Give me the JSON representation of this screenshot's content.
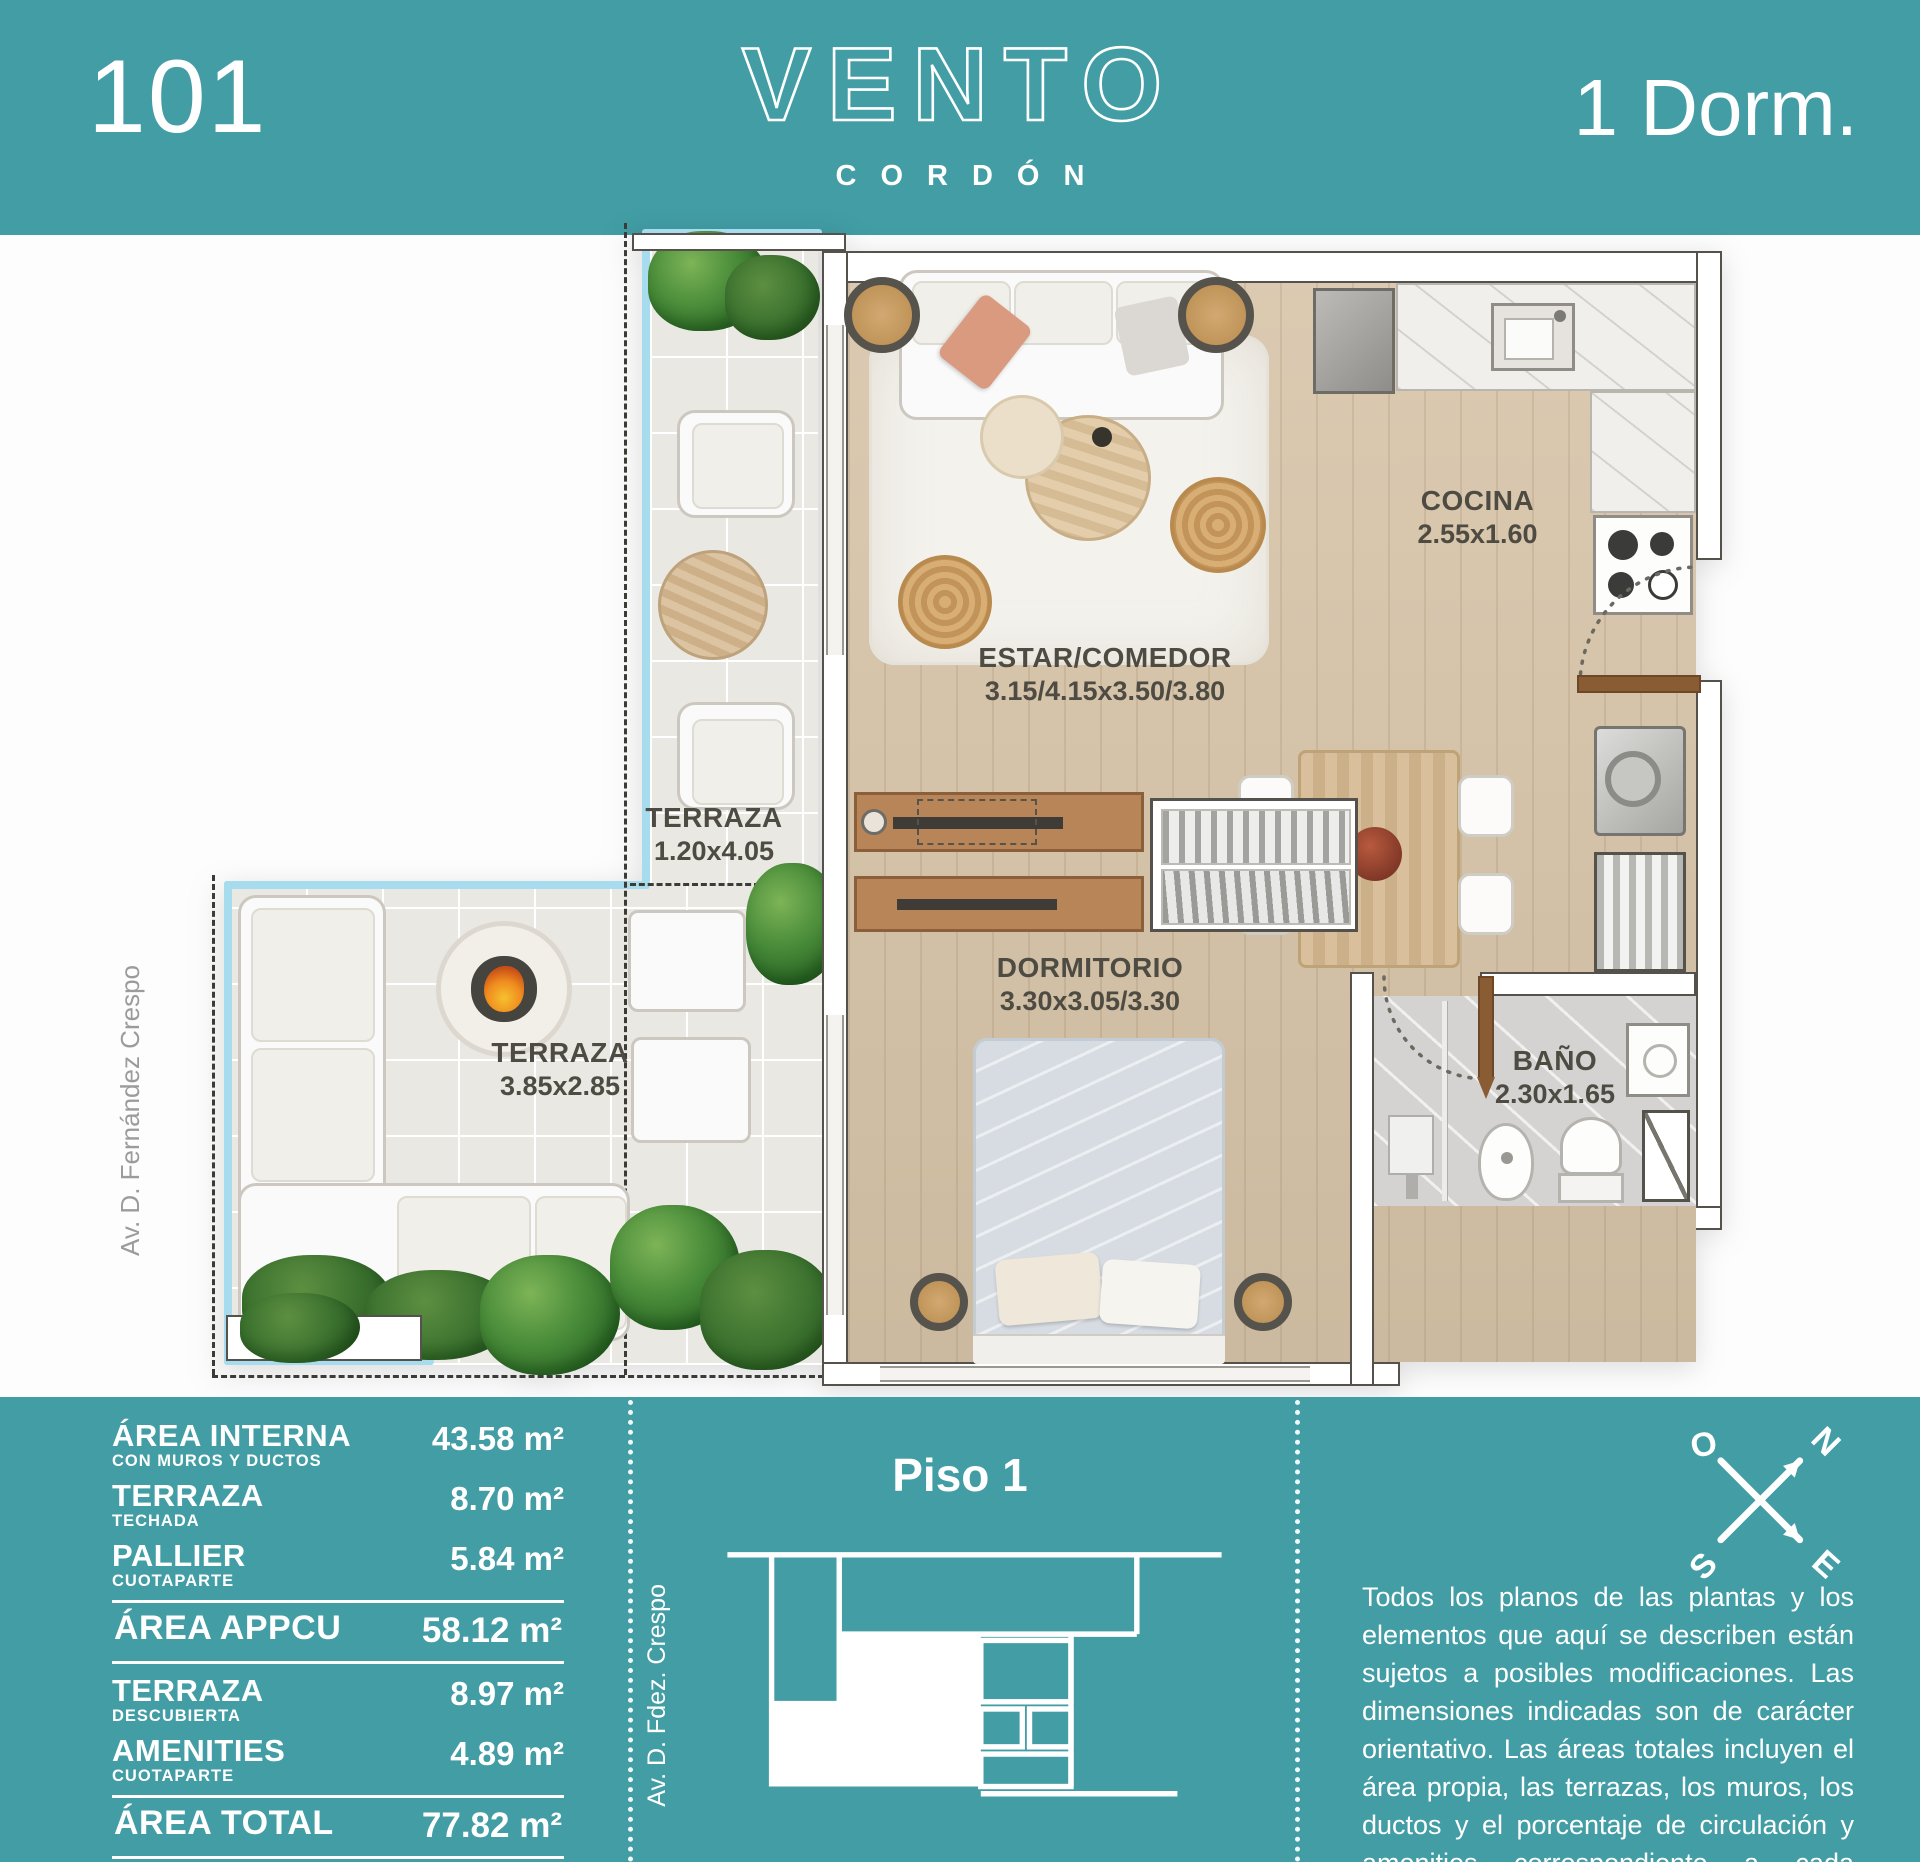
{
  "colors": {
    "teal": "#429da5",
    "wall_stroke": "#54524a",
    "wood_floor": "#d7c4a8",
    "door_wood": "#8a5c33",
    "glass_railing": "#a7dbee",
    "label_text": "#4d4b42"
  },
  "header": {
    "unit_number": "101",
    "brand": "VENTO",
    "brand_sub": "CORDÓN",
    "unit_type": "1 Dorm."
  },
  "plan": {
    "street": "Av. D. Fernández Crespo",
    "rooms": {
      "terraza_strip": {
        "name": "TERRAZA",
        "dims": "1.20x4.05"
      },
      "estar": {
        "name": "ESTAR/COMEDOR",
        "dims": "3.15/4.15x3.50/3.80"
      },
      "cocina": {
        "name": "COCINA",
        "dims": "2.55x1.60"
      },
      "dormitorio": {
        "name": "DORMITORIO",
        "dims": "3.30x3.05/3.30"
      },
      "bano": {
        "name": "BAÑO",
        "dims": "2.30x1.65"
      },
      "terraza_main": {
        "name": "TERRAZA",
        "dims": "3.85x2.85"
      }
    }
  },
  "footer": {
    "areas": [
      {
        "label": "ÁREA INTERNA",
        "sub": "CON MUROS Y DUCTOS",
        "value": "43.58 m²"
      },
      {
        "label": "TERRAZA",
        "sub": "TECHADA",
        "value": "8.70 m²"
      },
      {
        "label": "PALLIER",
        "sub": "CUOTAPARTE",
        "value": "5.84 m²"
      },
      {
        "label": "ÁREA APPCU",
        "sub": "",
        "value": "58.12 m²"
      },
      {
        "label": "TERRAZA",
        "sub": "DESCUBIERTA",
        "value": "8.97 m²"
      },
      {
        "label": "AMENITIES",
        "sub": "CUOTAPARTE",
        "value": "4.89 m²"
      },
      {
        "label": "ÁREA TOTAL",
        "sub": "",
        "value": "77.82 m²"
      }
    ],
    "keyplan": {
      "title": "Piso 1",
      "street": "Av. D. Fdez. Crespo"
    },
    "compass": {
      "o": "O",
      "n": "N",
      "s": "S",
      "e": "E"
    },
    "disclaimer": "Todos los planos de las plantas y los elementos que aquí se describen están sujetos a posibles modificaciones. Las dimensiones indicadas son de carácter orientativo. Las áreas totales incluyen el área propia, las terrazas, los muros, los ductos y el porcentaje de circulación y amenities correspondiente a cada unidad."
  }
}
